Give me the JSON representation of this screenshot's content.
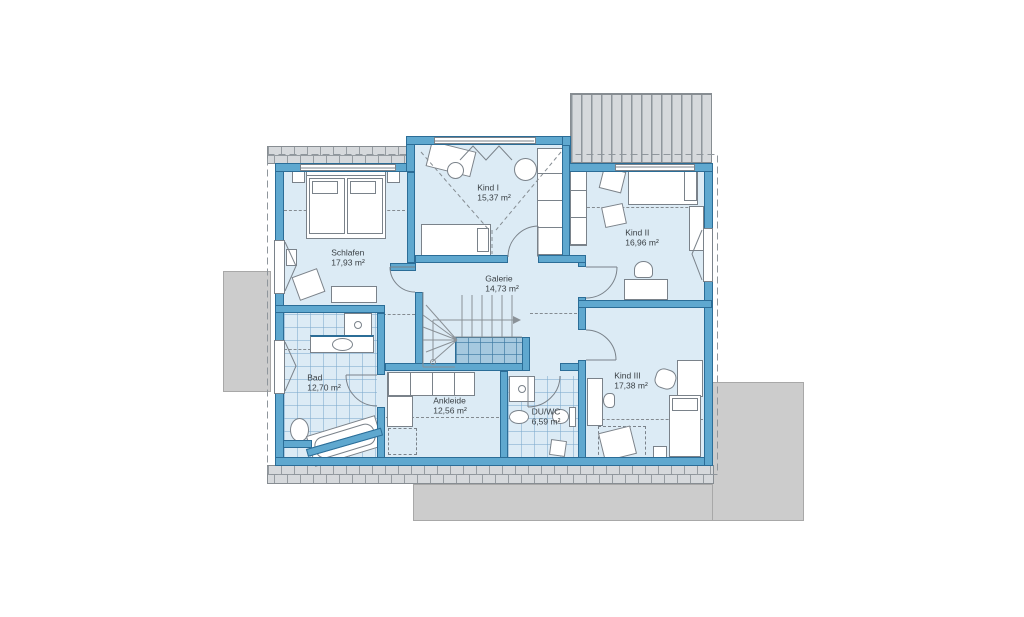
{
  "floorplan": {
    "type": "residential-upper-floor-plan",
    "rooms": [
      {
        "id": "schlafen",
        "name": "Schlafen",
        "area": "17,93 m²"
      },
      {
        "id": "kind-1",
        "name": "Kind I",
        "area": "15,37 m²"
      },
      {
        "id": "kind-2",
        "name": "Kind II",
        "area": "16,96 m²"
      },
      {
        "id": "galerie",
        "name": "Galerie",
        "area": "14,73 m²"
      },
      {
        "id": "bad",
        "name": "Bad",
        "area": "12,70 m²"
      },
      {
        "id": "ankleide",
        "name": "Ankleide",
        "area": "12,56 m²"
      },
      {
        "id": "du-wc",
        "name": "DU/WC",
        "area": "6,59 m²"
      },
      {
        "id": "kind-3",
        "name": "Kind III",
        "area": "17,38 m²"
      }
    ],
    "colors": {
      "wall_fill": "#5fa8cf",
      "wall_outline": "#2b6d97",
      "floor": "#dcebf5",
      "stair_void_fill": "#a5c9df",
      "roof_hatch_gray": "#d6d9dc",
      "terrace_gray": "#cccccc",
      "label_text": "#3a4045"
    }
  }
}
